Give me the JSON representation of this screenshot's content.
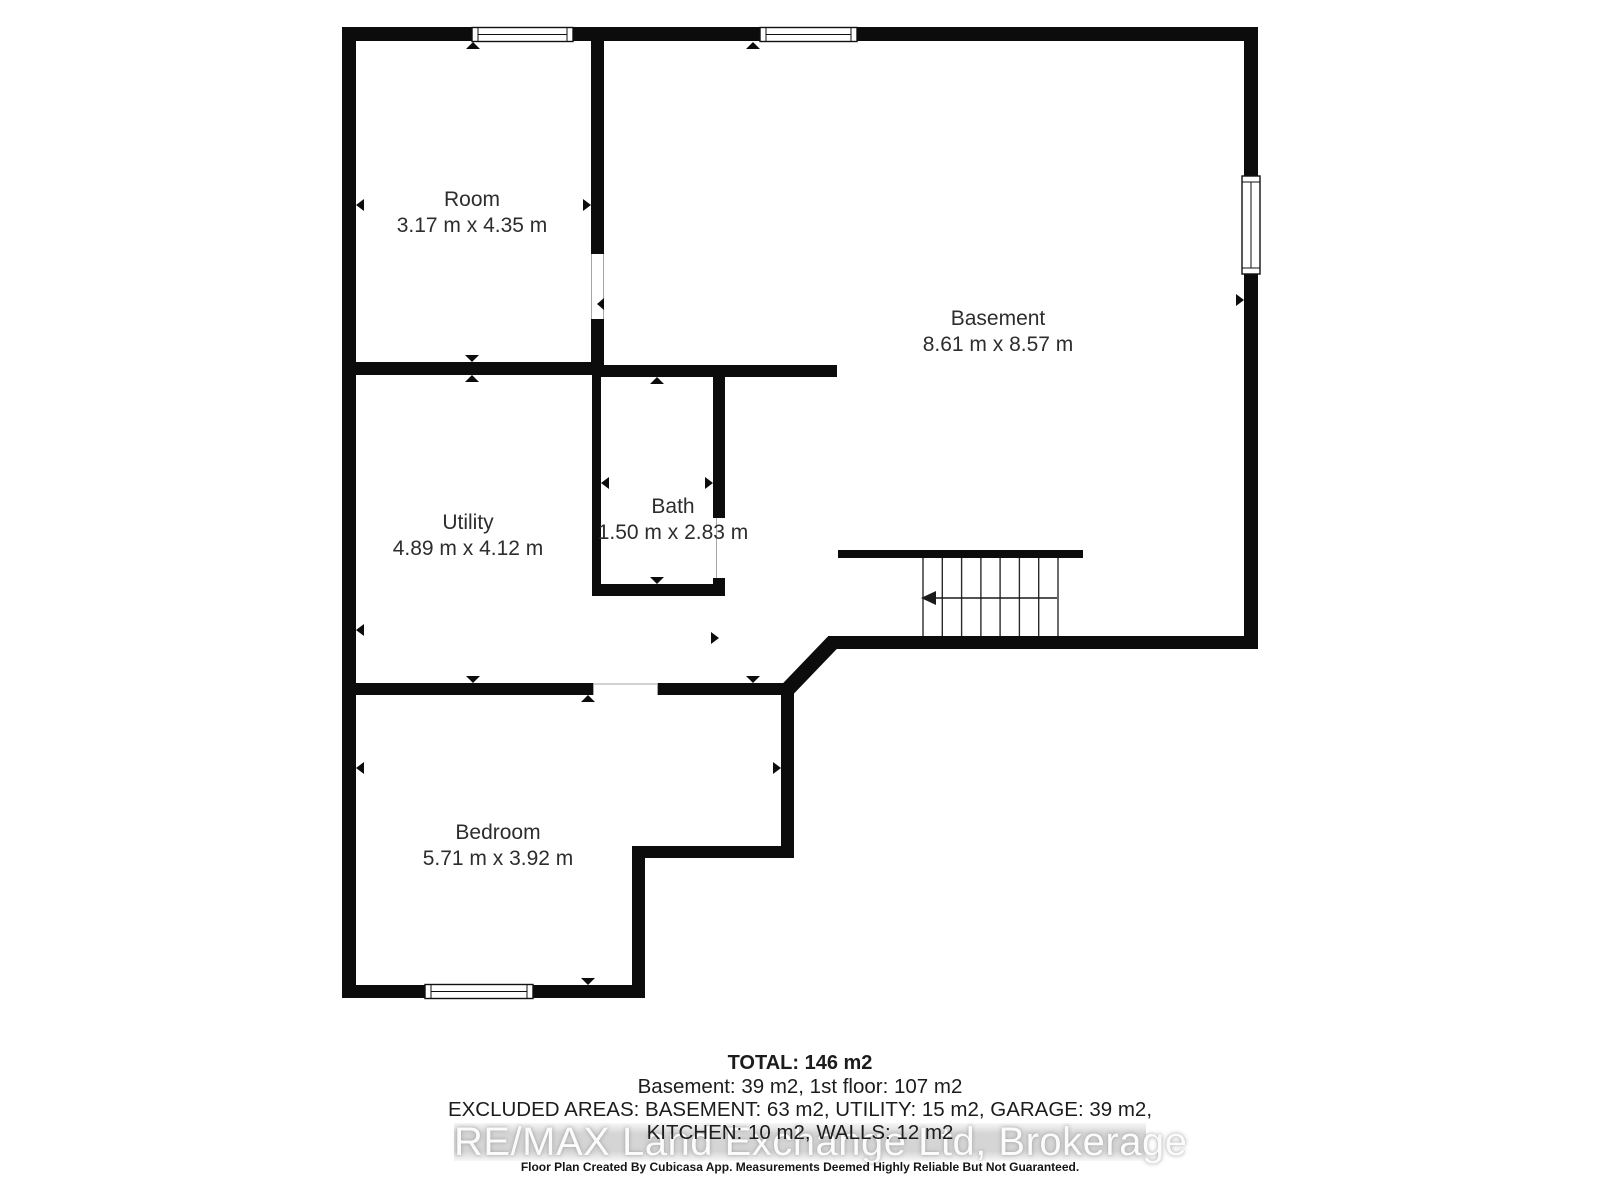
{
  "floor_plan": {
    "rooms": [
      {
        "name": "Room",
        "dimensions": "3.17 m x 4.35 m"
      },
      {
        "name": "Basement",
        "dimensions": "8.61 m x 8.57 m"
      },
      {
        "name": "Utility",
        "dimensions": "4.89 m x 4.12 m"
      },
      {
        "name": "Bath",
        "dimensions": "1.50 m x 2.83 m"
      },
      {
        "name": "Bedroom",
        "dimensions": "5.71 m x 3.92 m"
      }
    ],
    "colors": {
      "wall": "#0c0c0c",
      "label_text": "#2d2d2d",
      "background": "#ffffff",
      "watermark_band": "#b9b9b9"
    }
  },
  "summary": {
    "total": "TOTAL: 146 m2",
    "floors": "Basement: 39 m2, 1st floor: 107 m2",
    "excluded_line1": "EXCLUDED AREAS: BASEMENT: 63 m2, UTILITY: 15 m2, GARAGE: 39 m2,",
    "excluded_line2": "KITCHEN: 10 m2, WALLS: 12 m2"
  },
  "watermark": {
    "text": "RE/MAX Land Exchange Ltd, Brokerage"
  },
  "disclaimer": "Floor Plan Created By Cubicasa App. Measurements Deemed Highly Reliable But Not Guaranteed."
}
